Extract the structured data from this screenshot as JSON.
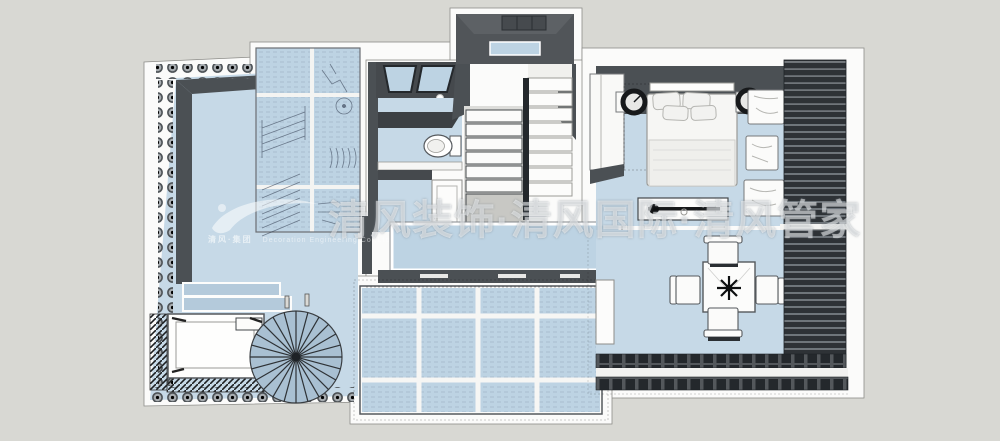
{
  "watermark": {
    "logo_text": "清风·集团",
    "logo_subtext": "Decoration Engineering Co.,Ltd",
    "main_text": "清风装饰·清风国际·清风管家"
  },
  "colors": {
    "background": "#d8d8d3",
    "plan_white": "#fbfbfa",
    "floor_blue": "#c6d9e7",
    "glass_blue": "#bdd3e3",
    "wall_dark": "#4b5054",
    "louver_dark": "#2e3236",
    "step_blue": "#b4cadb",
    "spiral_blue": "#a9c0d2",
    "landing_gray": "#c8c8c4"
  }
}
